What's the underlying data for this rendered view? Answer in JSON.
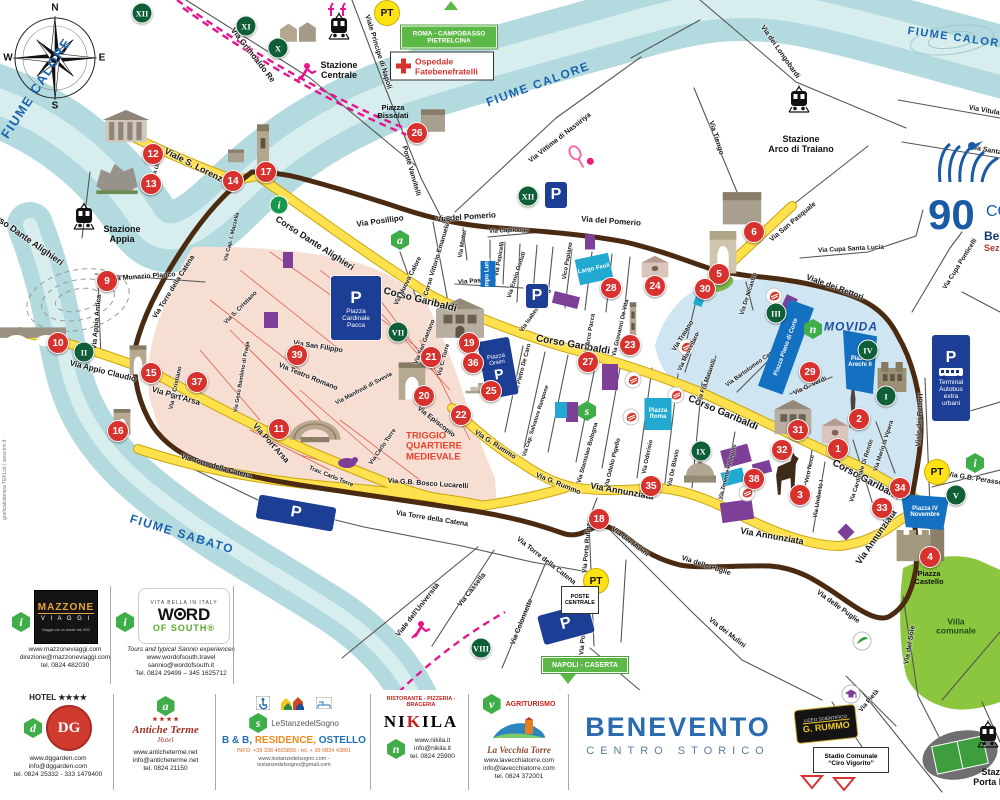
{
  "page_title": "Benevento Centro Storico - mappa turistica",
  "map_title": {
    "line1": "BENEVENTO",
    "line2": "CENTRO  STORICO"
  },
  "compass": {
    "n": "N",
    "e": "E",
    "s": "S",
    "w": "W"
  },
  "colors": {
    "river": "#b3dbdf",
    "yellow_road": "#ffe14d",
    "wall": "#4a2a10",
    "triggio": "#f7ded2",
    "movida": "#cfe5f2",
    "navy": "#1c3e94",
    "cyan": "#22a9d2",
    "purple": "#7d3f97",
    "badge_red": "#d8322f",
    "badge_green": "#0e5f38",
    "hex_green": "#3fae49",
    "villa_green": "#8cc63e",
    "sign_green": "#5cb947",
    "rail_pink": "#e8148c"
  },
  "river_labels": [
    {
      "t": "FIUME CALORE",
      "x": 36,
      "y": 88,
      "r": -57,
      "s": 13
    },
    {
      "t": "FIUME CALORE",
      "x": 538,
      "y": 84,
      "r": -20,
      "s": 12
    },
    {
      "t": "FIUME CALORE",
      "x": 958,
      "y": 38,
      "r": 8,
      "s": 11
    },
    {
      "t": "FIUME SABATO",
      "x": 182,
      "y": 534,
      "r": 17,
      "s": 12
    }
  ],
  "areas": {
    "triggio": {
      "l1": "TRIGGIO",
      "l2": "QUARTIERE",
      "l3": "MEDIEVALE",
      "x": 434,
      "y": 447
    },
    "movida": {
      "label": "MOVIDA",
      "x": 851,
      "y": 327
    },
    "villa": {
      "label": "Villa comunale",
      "x": 956,
      "y": 627
    }
  },
  "streets_fmt": "[text, x, y, rotationDeg, fontPx]",
  "streets": [
    [
      "Corso Dante Alighieri",
      315,
      243,
      33,
      9
    ],
    [
      "Corso Dante Alighieri",
      25,
      237,
      35,
      9
    ],
    [
      "Viale S. Lorenzo",
      196,
      166,
      27,
      9
    ],
    [
      "Corso Garibaldi",
      420,
      300,
      14,
      10
    ],
    [
      "Corso Garibaldi",
      573,
      345,
      10,
      10
    ],
    [
      "Corso Garibaldi",
      723,
      413,
      23,
      10
    ],
    [
      "Corso Garibaldi",
      866,
      480,
      28,
      10
    ],
    [
      "Via Appio Claudio",
      103,
      371,
      14,
      8
    ],
    [
      "Via Port'Arsa",
      176,
      396,
      16,
      8
    ],
    [
      "Via Port'Arsa",
      271,
      443,
      48,
      8
    ],
    [
      "Via G.B. Bosco Lucarelli",
      428,
      484,
      4,
      7
    ],
    [
      "Via Annunziata",
      622,
      491,
      10,
      9
    ],
    [
      "Via Annunziata",
      772,
      536,
      10,
      9
    ],
    [
      "Via Annunziata",
      876,
      537,
      -55,
      9
    ],
    [
      "Via del Pomerio",
      466,
      217,
      -4,
      8
    ],
    [
      "Via del Pomerio",
      611,
      221,
      4,
      8
    ],
    [
      "Via Posillipo",
      380,
      221,
      -8,
      8
    ],
    [
      "Viale Principe di Napoli",
      378,
      52,
      73,
      7
    ],
    [
      "Via Grimoaldo Re",
      253,
      55,
      52,
      8
    ],
    [
      "Ponte Vanvitelli",
      411,
      171,
      74,
      7
    ],
    [
      "Via Vittime di Nassiriya",
      560,
      138,
      -38,
      7
    ],
    [
      "Via dei Longobardi",
      780,
      52,
      55,
      7
    ],
    [
      "Via Tiengo",
      716,
      138,
      72,
      7
    ],
    [
      "Via San Pasquale",
      793,
      222,
      -40,
      7
    ],
    [
      "Via Cupa Santa Lucia",
      851,
      249,
      -3,
      6.5
    ],
    [
      "Viale dei Rettori",
      835,
      287,
      20,
      8
    ],
    [
      "Viale dei Rettori",
      920,
      420,
      -87,
      7
    ],
    [
      "Via Cupa Ponticelli",
      960,
      264,
      -58,
      6.5
    ],
    [
      "Via Munazio Planco",
      143,
      277,
      -4,
      7
    ],
    [
      "Via Appia Antica",
      97,
      322,
      -85,
      7
    ],
    [
      "Via Torre della Catena",
      216,
      467,
      16,
      7
    ],
    [
      "Via Torre della Catena",
      432,
      519,
      9,
      7
    ],
    [
      "Via Torre della Catena",
      546,
      561,
      38,
      7
    ],
    [
      "Via Torre della Catena",
      174,
      287,
      -58,
      7
    ],
    [
      "Via dei Mulini",
      630,
      542,
      37,
      7
    ],
    [
      "Via dei Mulini",
      727,
      633,
      38,
      7
    ],
    [
      "Via delle Puglie",
      838,
      607,
      36,
      7
    ],
    [
      "Via delle Puglie",
      706,
      566,
      18,
      7
    ],
    [
      "Via del Sole",
      910,
      645,
      -80,
      7
    ],
    [
      "Via Porta Rufina",
      587,
      548,
      -85,
      6.5
    ],
    [
      "Via Porta Rufina",
      584,
      630,
      -85,
      6.5
    ],
    [
      "Via Cassella",
      472,
      590,
      -52,
      7
    ],
    [
      "Via Colonnette",
      522,
      622,
      -68,
      7
    ],
    [
      "Viale dell'Università",
      418,
      610,
      -52,
      7
    ],
    [
      "Via G. Rummo",
      495,
      445,
      33,
      7
    ],
    [
      "Via G. Rummo",
      558,
      484,
      22,
      7
    ],
    [
      "Via Episcopio",
      436,
      422,
      38,
      7
    ],
    [
      "Via San Filippo",
      318,
      347,
      9,
      7
    ],
    [
      "Via Teatro Romano",
      308,
      377,
      22,
      7
    ],
    [
      "Via Manfredi di Svevia",
      364,
      389,
      -28,
      6
    ],
    [
      "Via San Gaetano",
      425,
      342,
      -68,
      6
    ],
    [
      "Via C. Torre",
      444,
      360,
      -75,
      6
    ],
    [
      "Via Carlo Torre",
      383,
      447,
      -55,
      6
    ],
    [
      "Trav. Carlo Torre",
      331,
      477,
      22,
      6
    ],
    [
      "Via S. Cristiano",
      241,
      308,
      -45,
      6
    ],
    [
      "Via S. Cristiano",
      176,
      388,
      -78,
      6
    ],
    [
      "Via Gesù Bambino di Praga",
      242,
      377,
      -80,
      5.5
    ],
    [
      "Corso Vittorio Emanuele III",
      438,
      256,
      -73,
      6.5
    ],
    [
      "Via Nuova Calore",
      408,
      281,
      -63,
      6.5
    ],
    [
      "Via Mattei",
      463,
      244,
      -80,
      6
    ],
    [
      "Via Capilongo",
      509,
      231,
      -3,
      6
    ],
    [
      "Via Pepicelli",
      500,
      259,
      -80,
      6
    ],
    [
      "Via Pasquali",
      477,
      281,
      -5,
      6.5
    ],
    [
      "Via Ennio Goduti",
      517,
      275,
      -72,
      6
    ],
    [
      "Vico Papiano",
      568,
      261,
      -80,
      6
    ],
    [
      "Via Isabella Morra",
      536,
      311,
      -55,
      6
    ],
    [
      "Via Arco Pacca",
      590,
      335,
      -80,
      6
    ],
    [
      "Via Giovanni De Vita",
      621,
      328,
      -77,
      6
    ],
    [
      "Via Pietro De Caro",
      523,
      369,
      -75,
      6
    ],
    [
      "Via Cap. Salvatore Rampone",
      536,
      421,
      -72,
      5.5
    ],
    [
      "Via Stanislao Bologna",
      588,
      453,
      -74,
      6
    ],
    [
      "Via Odelio Pigello",
      613,
      463,
      -76,
      6
    ],
    [
      "Via Oderisio",
      648,
      457,
      -78,
      6
    ],
    [
      "Via De Blasio",
      674,
      468,
      -78,
      6
    ],
    [
      "Via Traiano",
      683,
      336,
      -58,
      6.5
    ],
    [
      "Via Mascellaro",
      689,
      352,
      -64,
      6
    ],
    [
      "Via Frà Matarelli",
      707,
      381,
      -70,
      6
    ],
    [
      "Via Bartolomeo Camerario",
      757,
      364,
      -36,
      6
    ],
    [
      "Via G. Verdi",
      810,
      386,
      -25,
      6.5
    ],
    [
      "Via Cardinale Di Rende",
      862,
      471,
      -72,
      6
    ],
    [
      "Via Mario la Vipera",
      884,
      446,
      -72,
      6
    ],
    [
      "Via De Nicastro",
      749,
      294,
      -72,
      6
    ],
    [
      "Via G.B. Perasso",
      975,
      479,
      9,
      7
    ],
    [
      "Via Umberto I",
      819,
      499,
      -80,
      6
    ],
    [
      "Vico Noce",
      810,
      469,
      -78,
      6
    ],
    [
      "Via Tenente Pellegrini",
      728,
      472,
      -75,
      5.5
    ],
    [
      "Via Cap. I. Mazzella",
      232,
      237,
      -76,
      5.5
    ],
    [
      "Via Pietà",
      869,
      701,
      -50,
      6.5
    ],
    [
      "Via Vitulanese",
      992,
      112,
      10,
      7
    ],
    [
      "Via Santa Lucia",
      996,
      152,
      10,
      7
    ],
    [
      "Via Urso",
      157,
      168,
      -70,
      5.5
    ]
  ],
  "red_badges": [
    [
      "1",
      838,
      449
    ],
    [
      "2",
      859,
      419
    ],
    [
      "3",
      800,
      495
    ],
    [
      "4",
      930,
      557
    ],
    [
      "5",
      719,
      274
    ],
    [
      "6",
      754,
      232
    ],
    [
      "9",
      107,
      281
    ],
    [
      "10",
      58,
      343
    ],
    [
      "11",
      279,
      429
    ],
    [
      "12",
      153,
      154
    ],
    [
      "13",
      151,
      184
    ],
    [
      "14",
      233,
      181
    ],
    [
      "15",
      151,
      373
    ],
    [
      "16",
      118,
      431
    ],
    [
      "17",
      266,
      172
    ],
    [
      "18",
      599,
      519
    ],
    [
      "19",
      469,
      343
    ],
    [
      "20",
      424,
      396
    ],
    [
      "21",
      431,
      357
    ],
    [
      "22",
      461,
      415
    ],
    [
      "23",
      630,
      345
    ],
    [
      "24",
      655,
      286
    ],
    [
      "25",
      491,
      391
    ],
    [
      "26",
      417,
      133
    ],
    [
      "27",
      588,
      362
    ],
    [
      "28",
      611,
      288
    ],
    [
      "29",
      810,
      372
    ],
    [
      "30",
      705,
      289
    ],
    [
      "31",
      798,
      430
    ],
    [
      "32",
      782,
      450
    ],
    [
      "33",
      882,
      508
    ],
    [
      "34",
      900,
      488
    ],
    [
      "35",
      651,
      486
    ],
    [
      "36",
      473,
      363
    ],
    [
      "37",
      197,
      382
    ],
    [
      "38",
      754,
      479
    ],
    [
      "39",
      297,
      355
    ]
  ],
  "roman_badges": [
    [
      "I",
      886,
      396
    ],
    [
      "II",
      84,
      352
    ],
    [
      "III",
      776,
      313
    ],
    [
      "IV",
      868,
      350
    ],
    [
      "V",
      956,
      495
    ],
    [
      "VII",
      398,
      332
    ],
    [
      "VIII",
      481,
      648
    ],
    [
      "IX",
      701,
      451
    ],
    [
      "X",
      278,
      48
    ],
    [
      "XI",
      246,
      26
    ],
    [
      "XII",
      142,
      13
    ],
    [
      "XII",
      528,
      196
    ]
  ],
  "hex_markers": [
    [
      "a",
      400,
      240
    ],
    [
      "s",
      587,
      411
    ],
    [
      "n",
      813,
      329
    ],
    [
      "i",
      975,
      463
    ]
  ],
  "info_circle": {
    "l": "i",
    "x": 279,
    "y": 205
  },
  "parking_label": "P",
  "parkings": [
    [
      556,
      195,
      22,
      26,
      0
    ],
    [
      537,
      296,
      22,
      24,
      0
    ],
    [
      296,
      513,
      78,
      24,
      10
    ],
    [
      566,
      624,
      52,
      30,
      -15
    ]
  ],
  "pt_label": "PT",
  "pt_badges": [
    [
      387,
      13
    ],
    [
      596,
      581
    ],
    [
      937,
      472
    ]
  ],
  "pacca": {
    "p": "P",
    "l1": "Piazza",
    "l2": "Cardinale",
    "l3": "Pacca",
    "x": 356,
    "y": 308
  },
  "orsini": {
    "p": "P",
    "l1": "Piazza",
    "l2": "Orsini",
    "x": 498,
    "y": 368
  },
  "terminal": {
    "p": "P",
    "l1": "Terminal",
    "l2": "Autobus",
    "l3": "extra",
    "l4": "urbani",
    "x": 951,
    "y": 378
  },
  "poste": {
    "l1": "POSTE",
    "l2": "CENTRALE",
    "x": 580,
    "y": 600
  },
  "blue_piazzas": [
    {
      "t": "Largo Feoli",
      "x": 594,
      "y": 269,
      "w": 34,
      "h": 26,
      "r": -12,
      "cyan": true
    },
    {
      "t": "Piazza Roma",
      "x": 658,
      "y": 414,
      "w": 27,
      "h": 32,
      "r": 0,
      "cyan": true
    },
    {
      "t": "Campo Lungo",
      "x": 488,
      "y": 274,
      "w": 15,
      "h": 26,
      "r": 0,
      "vert": true
    },
    {
      "t": "Piazza Arechi II",
      "x": 860,
      "y": 362,
      "w": 34,
      "h": 64,
      "r": 0,
      "wedge": true
    },
    {
      "t": "Piazza IV Novembre",
      "x": 925,
      "y": 512,
      "w": 48,
      "h": 36,
      "r": 0,
      "wedge": true
    },
    {
      "t": "Piazza Piano di Corte",
      "x": 786,
      "y": 347,
      "w": 26,
      "h": 92,
      "r": 20,
      "vert": true
    }
  ],
  "signs": {
    "roma": {
      "l1": "ROMA - CAMPOBASSO",
      "l2": "PIETRELCINA",
      "x": 449,
      "y": 27
    },
    "ospedale": {
      "l1": "Ospedale",
      "l2": "Fatebenefratelli",
      "x": 442,
      "y": 58
    },
    "napoli": {
      "l1": "NAPOLI - CASERTA",
      "x": 585,
      "y": 665
    }
  },
  "stations": [
    {
      "l1": "Stazione",
      "l2": "Centrale",
      "x": 339,
      "y": 48,
      "ix": 339,
      "iy": 28
    },
    {
      "l1": "Stazione",
      "l2": "Appia",
      "x": 122,
      "y": 212,
      "ix": 84,
      "iy": 218
    },
    {
      "l1": "Stazione",
      "l2": "Arco di Traiano",
      "x": 801,
      "y": 122,
      "ix": 799,
      "iy": 101
    },
    {
      "l1": "Stazione",
      "l2": "Porta Rufina",
      "x": 1000,
      "y": 755,
      "ix": 988,
      "iy": 736
    }
  ],
  "piazza_texts": [
    {
      "l1": "Piazza",
      "l2": "Bissolati",
      "x": 393,
      "y": 112
    },
    {
      "l1": "Piazza",
      "l2": "Castello",
      "x": 929,
      "y": 578
    }
  ],
  "logo90": {
    "num": "90",
    "co": "CO",
    "ben": "Ben",
    "sez": "Sezio"
  },
  "school": {
    "l1": "LICEO SCIENTIFICO",
    "l2": "G. RUMMO"
  },
  "stadium": {
    "l1": "Stadio Comunale",
    "l2": "“Ciro Vigorito”"
  },
  "credits": "grafica&stampa TEKLcè  |  www.tmi.it",
  "mazzone": {
    "hex": "i",
    "name1": "MAZZONE",
    "name2": "V I A G G I",
    "tag": "Viaggia con un leader   dal 1922",
    "lines": [
      "www.mazzoneviaggi.com",
      "direzione@mazzoneviaggi.com",
      "tel. 0824 482030"
    ]
  },
  "wos": {
    "hex": "i",
    "top": "VITA BELLA IN ITALY",
    "w": "W",
    "rd": "RD",
    "of_south": "OF SOUTH®",
    "lines": [
      "Tours and typical Sannio experiences",
      "www.wordofsouth.travel",
      "sannio@wordofsouth.it",
      "Tel. 0824 29499 – 345 1625712"
    ]
  },
  "legend": {
    "dg": {
      "stars": "HOTEL ★★★★",
      "monogram": "DG",
      "hex": "d",
      "lines": [
        "www.dggarden.com",
        "info@dggarden.com",
        "tel. 0824 25332 - 333 1479400"
      ]
    },
    "terme": {
      "hex": "a",
      "stars": "★ ★ ★ ★",
      "name": "Antiche Terme",
      "sub": "Hotel",
      "lines": [
        "www.anticheterme.net",
        "info@anticheterme.net",
        "tel. 0824 21150"
      ]
    },
    "stanze": {
      "hex": "s",
      "name": "LeStanzedelSogno",
      "type_a": "B & B,",
      "type_b": "RESIDENCE,",
      "type_c": "OSTELLO",
      "info": "INFO: +39 338 4603859 - tel. + 39 0824 43891",
      "web": "www.lestanzedelsogno.com - lestanzedelsogno@gmail.com"
    },
    "nikila": {
      "header": "RISTORANTE - PIZZERIA - BRACERIA",
      "n1": "NI",
      "k": "K",
      "n2": "ILA",
      "hex": "n",
      "lines": [
        "www.nikila.it",
        "info@nikila.it",
        "tel. 0824 25900"
      ]
    },
    "vecchia": {
      "hex": "v",
      "header": "AGRITURISMO",
      "name": "La Vecchia Torre",
      "lines": [
        "www.lavecchiatorre.com",
        "info@lavecchiatorre.com",
        "tel. 0824 372001"
      ]
    }
  }
}
